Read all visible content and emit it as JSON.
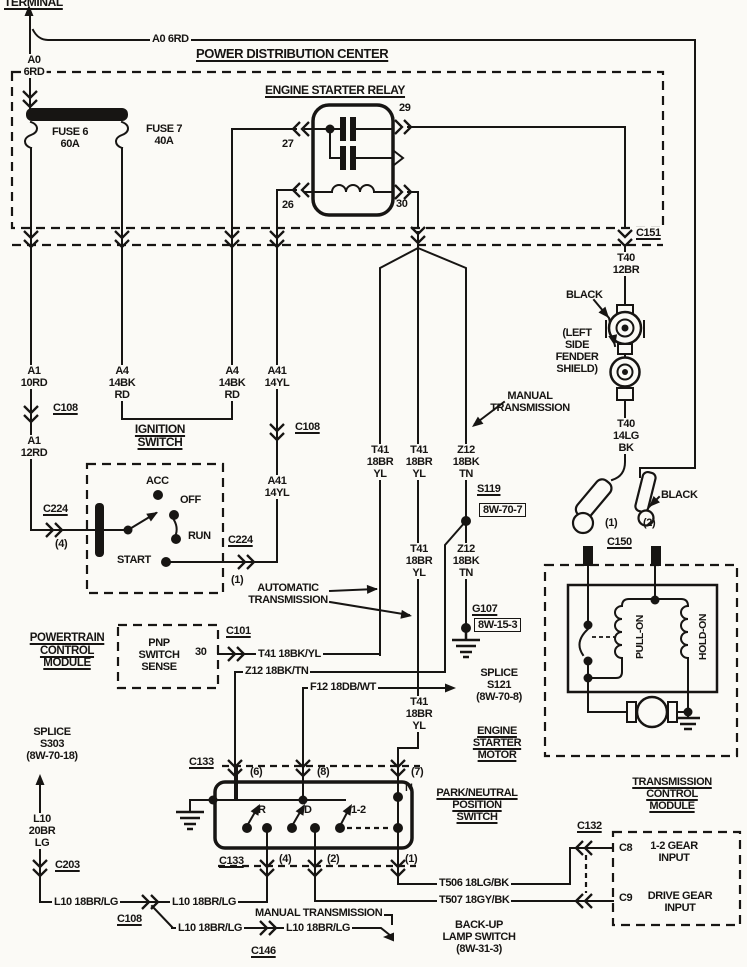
{
  "diagram": {
    "type": "automotive-wiring-diagram",
    "colors": {
      "ink": "#171513",
      "paper": "#fbfaf6"
    },
    "labels": [
      {
        "id": "terminal-title",
        "text": "TERMINAL",
        "x": 4,
        "y": -4,
        "ul": true,
        "fs": 12
      },
      {
        "id": "a0-wire-top",
        "text": "A0 6RD",
        "x": 150,
        "y": 33,
        "bg": true
      },
      {
        "id": "pdc-title",
        "text": "POWER DISTRIBUTION CENTER",
        "x": 196,
        "y": 47,
        "ul": true,
        "fs": 13
      },
      {
        "id": "a0-wire-vert",
        "text": "A0\n6RD",
        "x": 34,
        "y": 54,
        "anchor": "center",
        "bg": true
      },
      {
        "id": "fuse6",
        "text": "FUSE 6\n60A",
        "x": 70,
        "y": 126,
        "anchor": "center"
      },
      {
        "id": "fuse7",
        "text": "FUSE 7\n40A",
        "x": 164,
        "y": 123,
        "anchor": "center"
      },
      {
        "id": "esr-title",
        "text": "ENGINE STARTER RELAY",
        "x": 265,
        "y": 84,
        "ul": true,
        "fs": 12
      },
      {
        "id": "relay-pin27",
        "text": "27",
        "x": 282,
        "y": 138
      },
      {
        "id": "relay-pin29",
        "text": "29",
        "x": 399,
        "y": 102
      },
      {
        "id": "relay-pin26",
        "text": "26",
        "x": 282,
        "y": 199
      },
      {
        "id": "relay-pin30",
        "text": "30",
        "x": 396,
        "y": 198
      },
      {
        "id": "c151",
        "text": "C151",
        "x": 634,
        "y": 227,
        "ul": true,
        "bg": true
      },
      {
        "id": "t40-12br",
        "text": "T40\n12BR",
        "x": 626,
        "y": 252,
        "anchor": "center",
        "bg": true
      },
      {
        "id": "black-upper",
        "text": "BLACK",
        "x": 566,
        "y": 289
      },
      {
        "id": "fender-note",
        "text": "(LEFT\nSIDE\nFENDER\nSHIELD)",
        "x": 577,
        "y": 327,
        "anchor": "center"
      },
      {
        "id": "t40-14lg",
        "text": "T40\n14LG\nBK",
        "x": 626,
        "y": 418,
        "anchor": "center",
        "bg": true
      },
      {
        "id": "black-lower",
        "text": "BLACK",
        "x": 661,
        "y": 489
      },
      {
        "id": "term1-num",
        "text": "(1)",
        "x": 605,
        "y": 517
      },
      {
        "id": "term2-num",
        "text": "(2)",
        "x": 643,
        "y": 517
      },
      {
        "id": "c150",
        "text": "C150",
        "x": 607,
        "y": 536,
        "ul": true
      },
      {
        "id": "a1-10rd",
        "text": "A1\n10RD",
        "x": 34,
        "y": 365,
        "anchor": "center",
        "bg": true
      },
      {
        "id": "c108-a",
        "text": "C108",
        "x": 51,
        "y": 402,
        "ul": true,
        "bg": true
      },
      {
        "id": "a1-12rd",
        "text": "A1\n12RD",
        "x": 34,
        "y": 435,
        "anchor": "center",
        "bg": true
      },
      {
        "id": "a4-left",
        "text": "A4\n14BK\nRD",
        "x": 122,
        "y": 365,
        "anchor": "center",
        "bg": true
      },
      {
        "id": "a4-right",
        "text": "A4\n14BK\nRD",
        "x": 232,
        "y": 365,
        "anchor": "center",
        "bg": true
      },
      {
        "id": "a41-upper",
        "text": "A41\n14YL",
        "x": 277,
        "y": 365,
        "anchor": "center",
        "bg": true
      },
      {
        "id": "c108-b",
        "text": "C108",
        "x": 293,
        "y": 421,
        "ul": true,
        "bg": true
      },
      {
        "id": "a41-lower",
        "text": "A41\n14YL",
        "x": 277,
        "y": 475,
        "anchor": "center",
        "bg": true
      },
      {
        "id": "ign-title",
        "text": "IGNITION\nSWITCH",
        "x": 160,
        "y": 423,
        "anchor": "center",
        "ul": true,
        "fs": 12
      },
      {
        "id": "ign-acc",
        "text": "ACC",
        "x": 146,
        "y": 475
      },
      {
        "id": "ign-off",
        "text": "OFF",
        "x": 180,
        "y": 494
      },
      {
        "id": "ign-run",
        "text": "RUN",
        "x": 188,
        "y": 530
      },
      {
        "id": "ign-start",
        "text": "START",
        "x": 117,
        "y": 554
      },
      {
        "id": "c224-left",
        "text": "C224",
        "x": 43,
        "y": 503,
        "ul": true
      },
      {
        "id": "c224-left-pin",
        "text": "(4)",
        "x": 55,
        "y": 538
      },
      {
        "id": "c224-right",
        "text": "C224",
        "x": 228,
        "y": 534,
        "ul": true
      },
      {
        "id": "c224-right-pin",
        "text": "(1)",
        "x": 231,
        "y": 574
      },
      {
        "id": "manual-trans-upper",
        "text": "MANUAL\nTRANSMISSION",
        "x": 530,
        "y": 390,
        "anchor": "center"
      },
      {
        "id": "t41-v1",
        "text": "T41\n18BR\nYL",
        "x": 380,
        "y": 444,
        "anchor": "center",
        "bg": true
      },
      {
        "id": "t41-v2",
        "text": "T41\n18BR\nYL",
        "x": 419,
        "y": 444,
        "anchor": "center",
        "bg": true
      },
      {
        "id": "z12-v1",
        "text": "Z12\n18BK\nTN",
        "x": 466,
        "y": 444,
        "anchor": "center",
        "bg": true
      },
      {
        "id": "s119",
        "text": "S119",
        "x": 477,
        "y": 483,
        "ul": true
      },
      {
        "id": "s119-ref",
        "text": "8W-70-7",
        "x": 479,
        "y": 503,
        "box": true
      },
      {
        "id": "t41-v3",
        "text": "T41\n18BR\nYL",
        "x": 419,
        "y": 543,
        "anchor": "center",
        "bg": true
      },
      {
        "id": "z12-v2",
        "text": "Z12\n18BK\nTN",
        "x": 466,
        "y": 543,
        "anchor": "center",
        "bg": true
      },
      {
        "id": "auto-trans",
        "text": "AUTOMATIC\nTRANSMISSION",
        "x": 288,
        "y": 582,
        "anchor": "center"
      },
      {
        "id": "g107",
        "text": "G107",
        "x": 472,
        "y": 603,
        "ul": true
      },
      {
        "id": "g107-ref",
        "text": "8W-15-3",
        "x": 474,
        "y": 618,
        "box": true
      },
      {
        "id": "pcm-title",
        "text": "POWERTRAIN\nCONTROL\nMODULE",
        "x": 67,
        "y": 632,
        "anchor": "center",
        "ul": true,
        "fs": 11.5
      },
      {
        "id": "pnp-sense",
        "text": "PNP\nSWITCH\nSENSE",
        "x": 159,
        "y": 637,
        "anchor": "center"
      },
      {
        "id": "pcm-pin30",
        "text": "30",
        "x": 195,
        "y": 646
      },
      {
        "id": "c101",
        "text": "C101",
        "x": 226,
        "y": 625,
        "ul": true
      },
      {
        "id": "t41-link",
        "text": "T41 18BK/YL",
        "x": 256,
        "y": 648,
        "bg": true
      },
      {
        "id": "z12-link",
        "text": "Z12 18BK/TN",
        "x": 243,
        "y": 665,
        "bg": true
      },
      {
        "id": "f12-link",
        "text": "F12 18DB/WT",
        "x": 308,
        "y": 681,
        "bg": true
      },
      {
        "id": "s121",
        "text": "SPLICE\nS121\n(8W-70-8)",
        "x": 499,
        "y": 667,
        "anchor": "center"
      },
      {
        "id": "t41-v4",
        "text": "T41\n18BR\nYL",
        "x": 419,
        "y": 696,
        "anchor": "center",
        "bg": true
      },
      {
        "id": "esm-title",
        "text": "ENGINE\nSTARTER\nMOTOR",
        "x": 497,
        "y": 725,
        "anchor": "center",
        "ul": true
      },
      {
        "id": "s303",
        "text": "SPLICE\nS303\n(8W-70-18)",
        "x": 52,
        "y": 726,
        "anchor": "center"
      },
      {
        "id": "l10-vert",
        "text": "L10\n20BR\nLG",
        "x": 42,
        "y": 813,
        "anchor": "center",
        "bg": true
      },
      {
        "id": "c133-top",
        "text": "C133",
        "x": 189,
        "y": 756,
        "ul": true
      },
      {
        "id": "pin6",
        "text": "(6)",
        "x": 250,
        "y": 766
      },
      {
        "id": "pin8",
        "text": "(8)",
        "x": 317,
        "y": 766
      },
      {
        "id": "pin7",
        "text": "(7)",
        "x": 411,
        "y": 766
      },
      {
        "id": "pnp-n",
        "text": "N",
        "x": 405,
        "y": 782
      },
      {
        "id": "pnp-r",
        "text": "R",
        "x": 258,
        "y": 804
      },
      {
        "id": "pnp-d",
        "text": "D",
        "x": 304,
        "y": 804
      },
      {
        "id": "pnp-12",
        "text": "1-2",
        "x": 351,
        "y": 804
      },
      {
        "id": "pnp-title",
        "text": "PARK/NEUTRAL\nPOSITION\nSWITCH",
        "x": 477,
        "y": 787,
        "anchor": "center",
        "ul": true
      },
      {
        "id": "c133-bottom",
        "text": "C133",
        "x": 219,
        "y": 855,
        "ul": true
      },
      {
        "id": "pin4",
        "text": "(4)",
        "x": 279,
        "y": 853
      },
      {
        "id": "pin2",
        "text": "(2)",
        "x": 327,
        "y": 853
      },
      {
        "id": "pin1",
        "text": "(1)",
        "x": 405,
        "y": 853
      },
      {
        "id": "tcm-title",
        "text": "TRANSMISSION\nCONTROL\nMODULE",
        "x": 672,
        "y": 776,
        "anchor": "center",
        "ul": true
      },
      {
        "id": "c132",
        "text": "C132",
        "x": 577,
        "y": 820,
        "ul": true
      },
      {
        "id": "c8-pin",
        "text": "C8",
        "x": 619,
        "y": 842
      },
      {
        "id": "c8-desc",
        "text": "1-2 GEAR\nINPUT",
        "x": 674,
        "y": 840,
        "anchor": "center"
      },
      {
        "id": "c9-pin",
        "text": "C9",
        "x": 619,
        "y": 892
      },
      {
        "id": "c9-desc",
        "text": "DRIVE GEAR\nINPUT",
        "x": 680,
        "y": 890,
        "anchor": "center"
      },
      {
        "id": "t506",
        "text": "T506 18LG/BK",
        "x": 437,
        "y": 877,
        "bg": true
      },
      {
        "id": "t507",
        "text": "T507 18GY/BK",
        "x": 437,
        "y": 894,
        "bg": true
      },
      {
        "id": "c203",
        "text": "C203",
        "x": 55,
        "y": 859,
        "ul": true
      },
      {
        "id": "l10-seg1",
        "text": "L10 18BR/LG",
        "x": 52,
        "y": 896,
        "bg": true
      },
      {
        "id": "l10-seg2",
        "text": "L10 18BR/LG",
        "x": 170,
        "y": 896,
        "bg": true
      },
      {
        "id": "c108-c",
        "text": "C108",
        "x": 117,
        "y": 913,
        "ul": true
      },
      {
        "id": "l10-seg3",
        "text": "L10 18BR/LG",
        "x": 176,
        "y": 922,
        "bg": true
      },
      {
        "id": "manual-trans-lower",
        "text": "MANUAL TRANSMISSION",
        "x": 253,
        "y": 907,
        "bg": true
      },
      {
        "id": "l10-seg4",
        "text": "L10 18BR/LG",
        "x": 284,
        "y": 922,
        "bg": true
      },
      {
        "id": "c146",
        "text": "C146",
        "x": 251,
        "y": 945,
        "ul": true
      },
      {
        "id": "backup-switch",
        "text": "BACK-UP\nLAMP SWITCH\n(8W-31-3)",
        "x": 479,
        "y": 919,
        "anchor": "center"
      },
      {
        "id": "pull-on",
        "text": "PULL-ON",
        "x": 641,
        "y": 637,
        "vert": true,
        "fs": 10.5
      },
      {
        "id": "hold-on",
        "text": "HOLD-ON",
        "x": 704,
        "y": 637,
        "vert": true,
        "fs": 10.5
      }
    ]
  }
}
